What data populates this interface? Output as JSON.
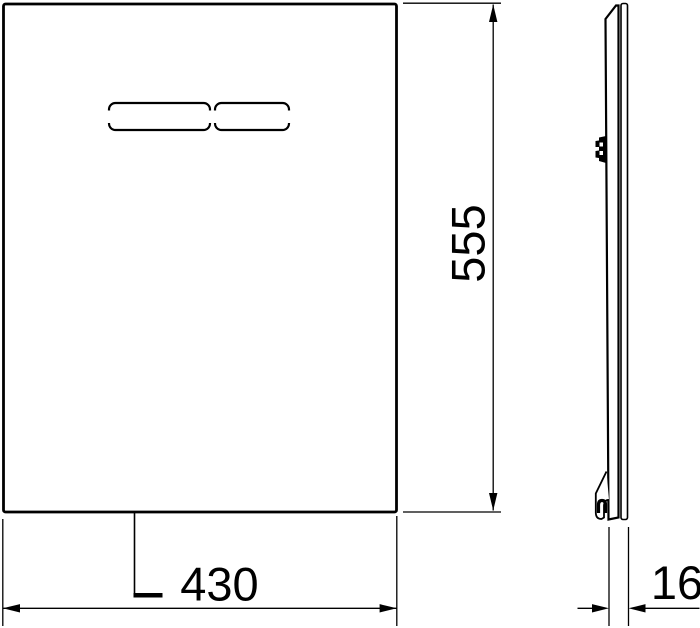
{
  "colors": {
    "line": "#000000",
    "background": "#ffffff"
  },
  "dimensions": {
    "width": {
      "value": "430"
    },
    "height": {
      "value": "555"
    },
    "depth": {
      "value": "16"
    }
  }
}
